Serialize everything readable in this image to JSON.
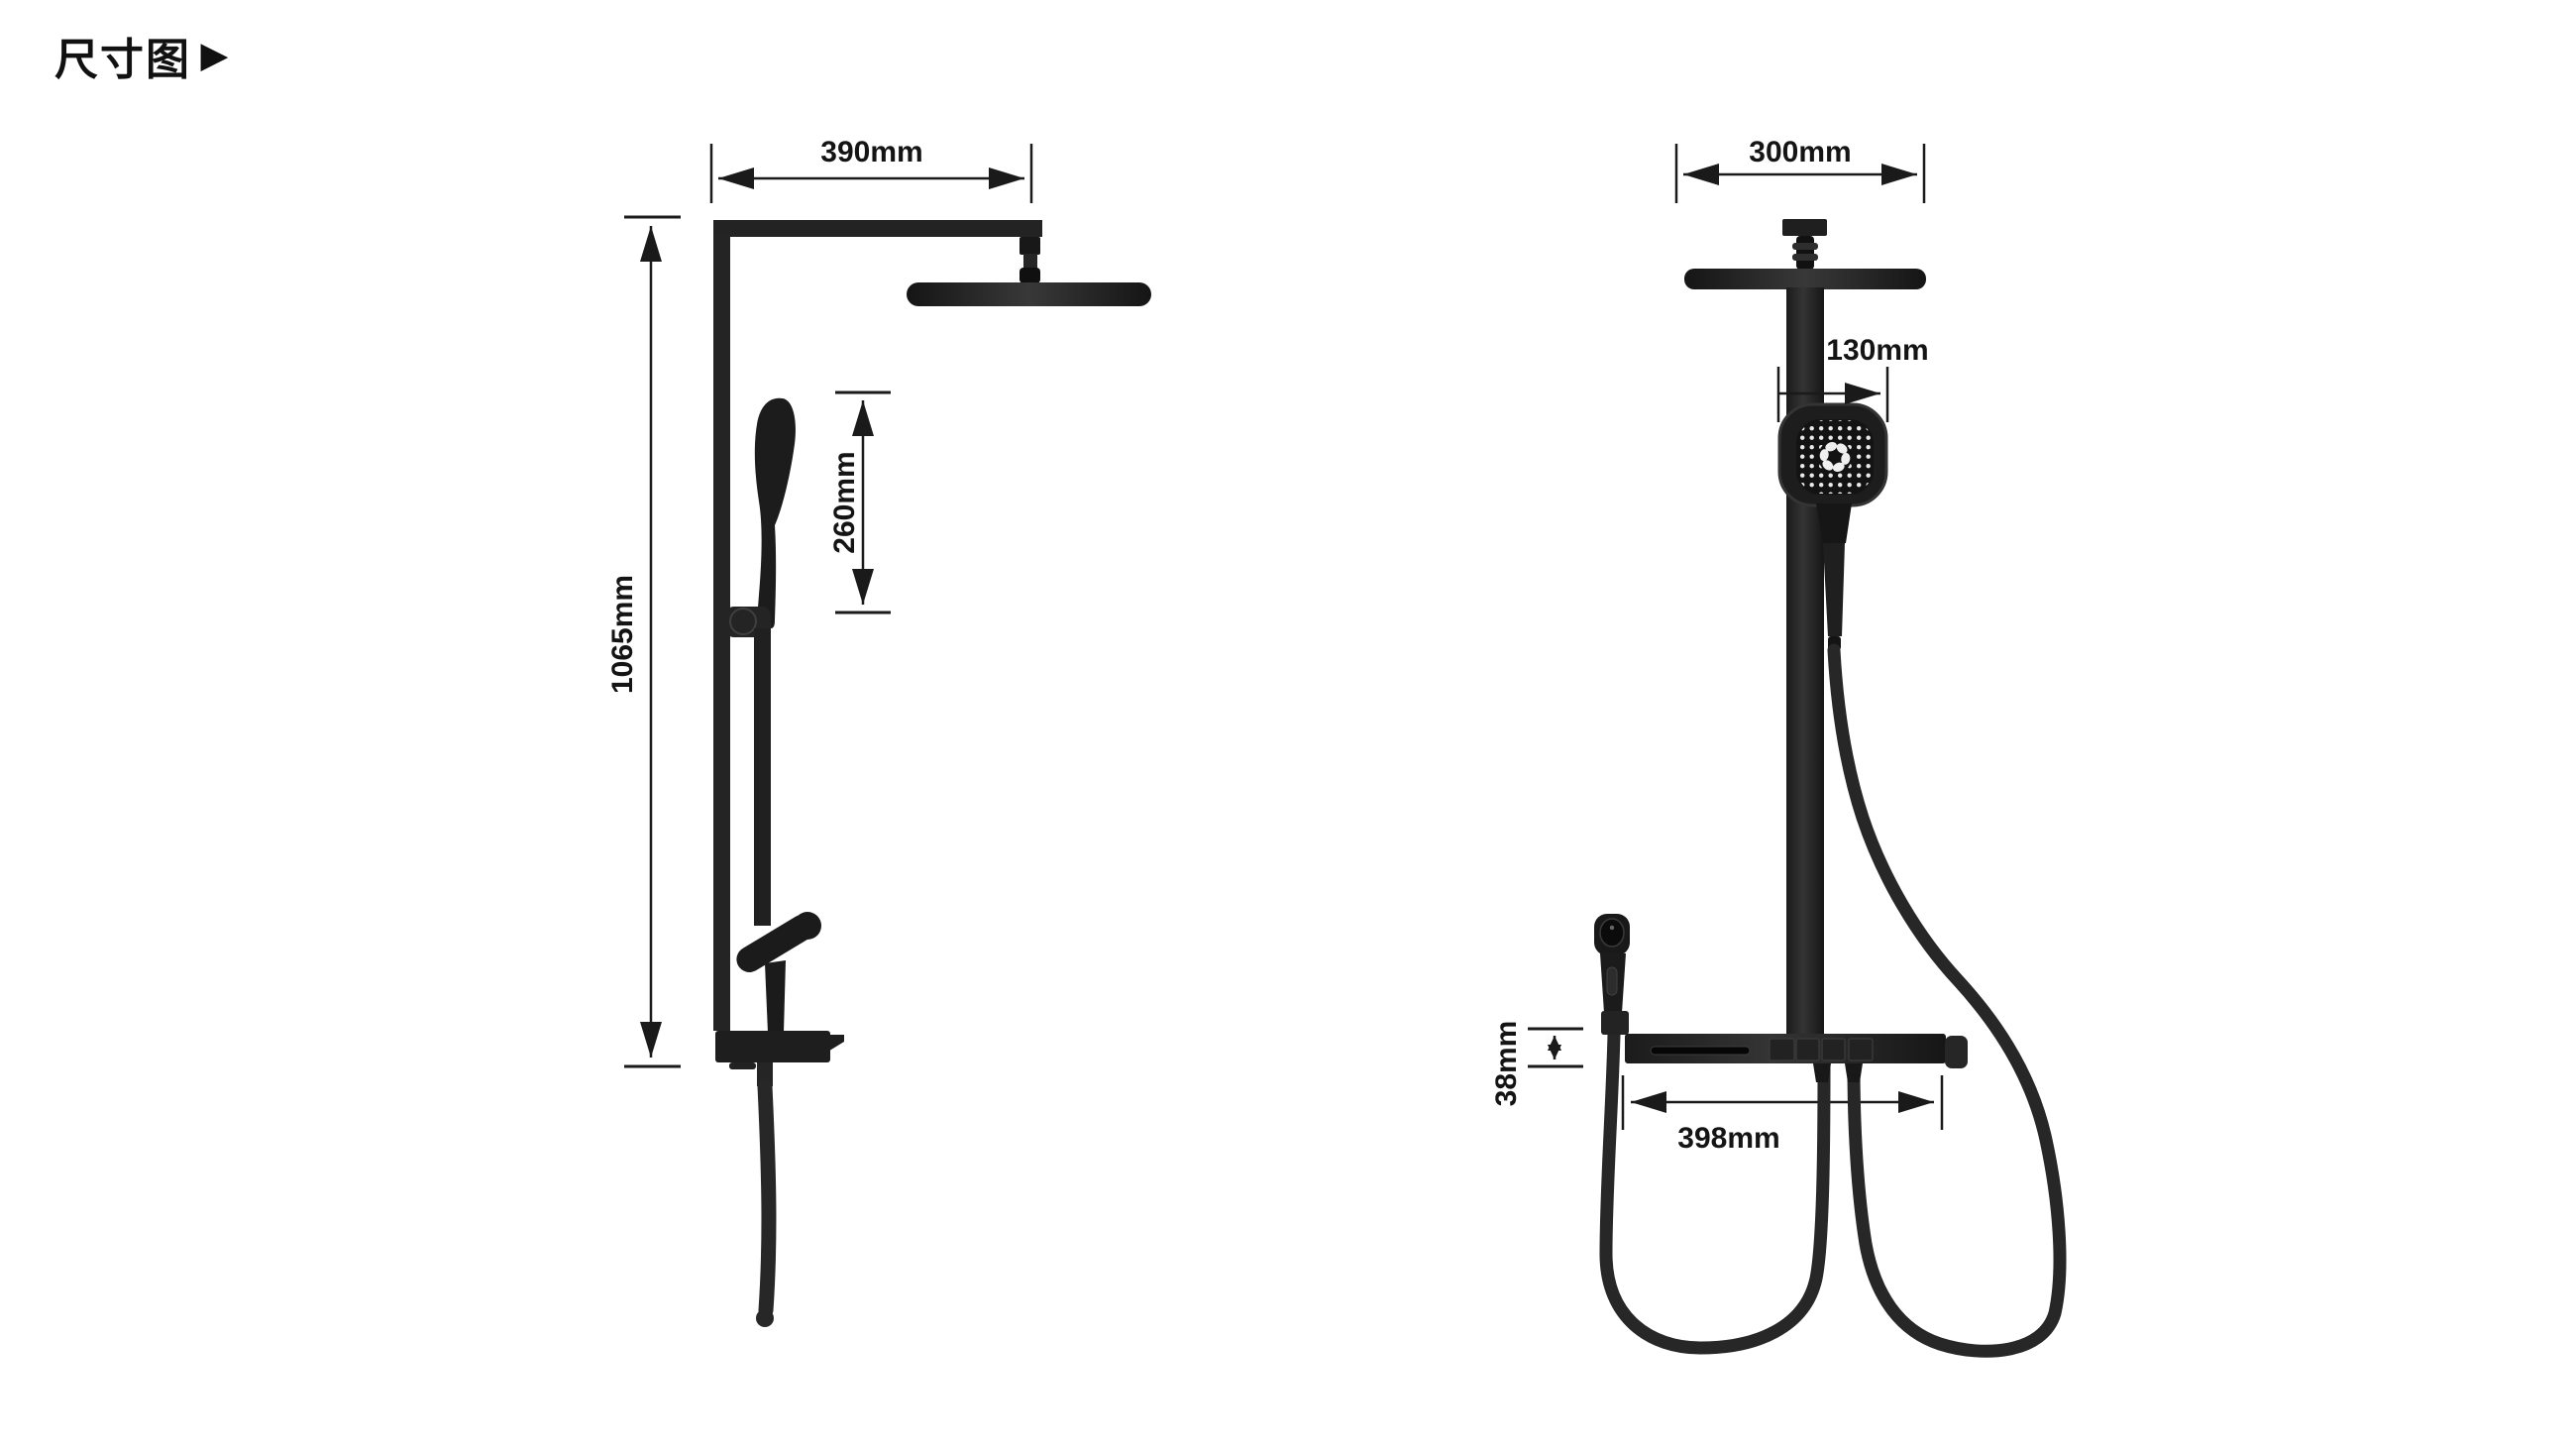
{
  "page": {
    "title": "尺寸图",
    "title_marker": "▶",
    "background": "#ffffff"
  },
  "colors": {
    "product_black": "#1f1f1f",
    "product_sheen": "#353535",
    "hose": "#272727",
    "dimension_line": "#1a1a1a",
    "label_text": "#141414",
    "nozzle_dots": "#ededed"
  },
  "side_view": {
    "name": "shower system side view",
    "dimensions": {
      "arm_reach": "390mm",
      "column_height": "1065mm",
      "slide_travel": "260mm"
    }
  },
  "front_view": {
    "name": "shower system front view",
    "dimensions": {
      "overhead_width": "300mm",
      "handheld_width": "130mm",
      "shelf_thickness": "38mm",
      "shelf_length": "398mm"
    }
  }
}
